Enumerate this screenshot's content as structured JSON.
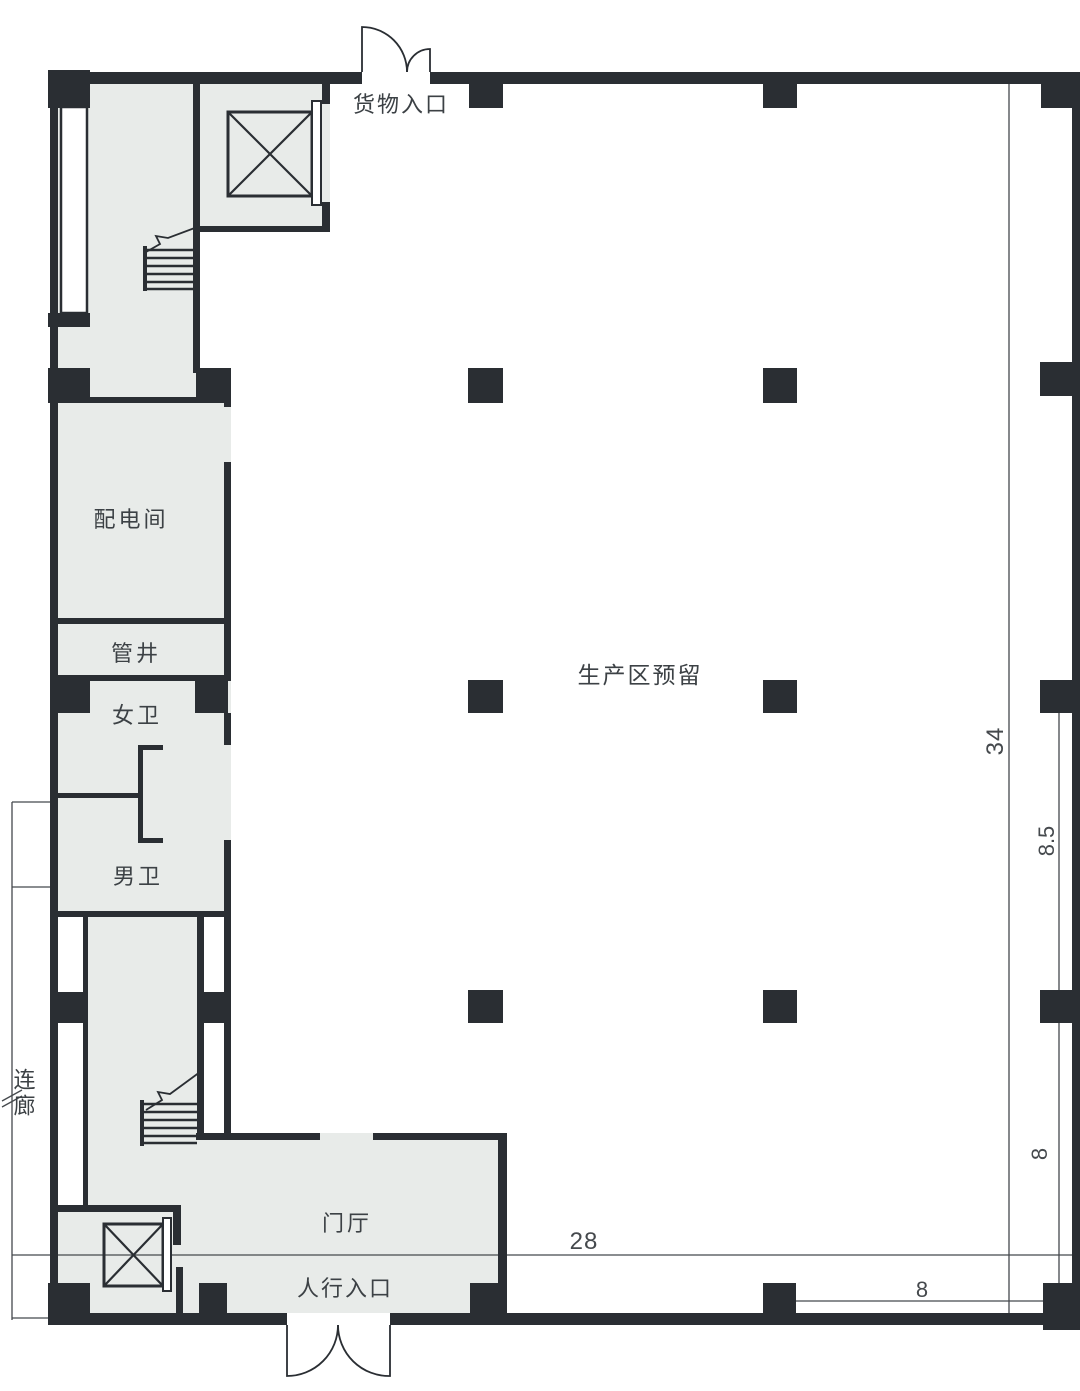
{
  "title": "factory-floor-plan",
  "colors": {
    "wall": "#2a2e33",
    "room_fill": "#e8ebe9",
    "dimension_line": "#45494d",
    "label_text": "#3c4145",
    "background": "#ffffff"
  },
  "rooms": {
    "cargo_entrance": "货物入口",
    "power_distribution_room": "配电间",
    "pipe_shaft": "管井",
    "womens_toilet": "女卫",
    "mens_toilet": "男卫",
    "connecting_corridor": "连廊",
    "foyer": "门厅",
    "pedestrian_entrance": "人行入口",
    "production_area_reserved": "生产区预留"
  },
  "dimensions": {
    "overall_depth": "34",
    "right_bay_upper": "8.5",
    "right_bay_lower": "8",
    "bottom_width": "28",
    "bottom_bay": "8"
  }
}
